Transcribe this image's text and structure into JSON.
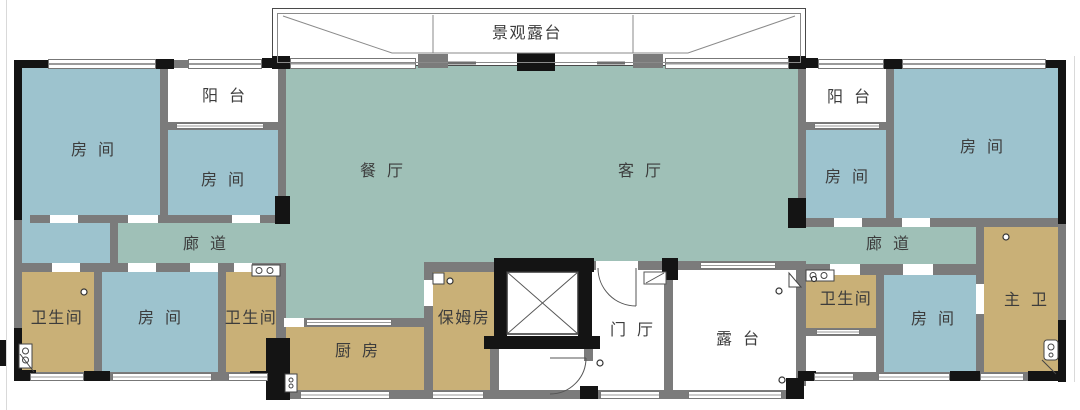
{
  "colors": {
    "bedroom": "#9dc3ce",
    "living": "#9fc0b7",
    "service": "#c9b077",
    "wall": "#7b7b7b",
    "wall_dark": "#141414",
    "window_frame": "#777777",
    "label": "#3c3c3c",
    "paper": "#ffffff"
  },
  "rooms": {
    "scenic_terrace": "景观露台",
    "balcony_left": "阳台",
    "bedroom_left_large": "房间",
    "bedroom_left_small": "房间",
    "dining_room": "餐厅",
    "living_room": "客厅",
    "corridor_left": "廊道",
    "corridor_right": "廊道",
    "bathroom_left": "卫生间",
    "bedroom_bottom_left": "房间",
    "bathroom_left_2": "卫生间",
    "kitchen": "厨房",
    "nanny_room": "保姆房",
    "entry_hall": "门厅",
    "terrace": "露台",
    "balcony_right": "阳台",
    "bedroom_right_small": "房间",
    "bedroom_right_large": "房间",
    "bathroom_right": "卫生间",
    "bedroom_bottom_right": "房间",
    "master_bathroom": "主卫"
  }
}
